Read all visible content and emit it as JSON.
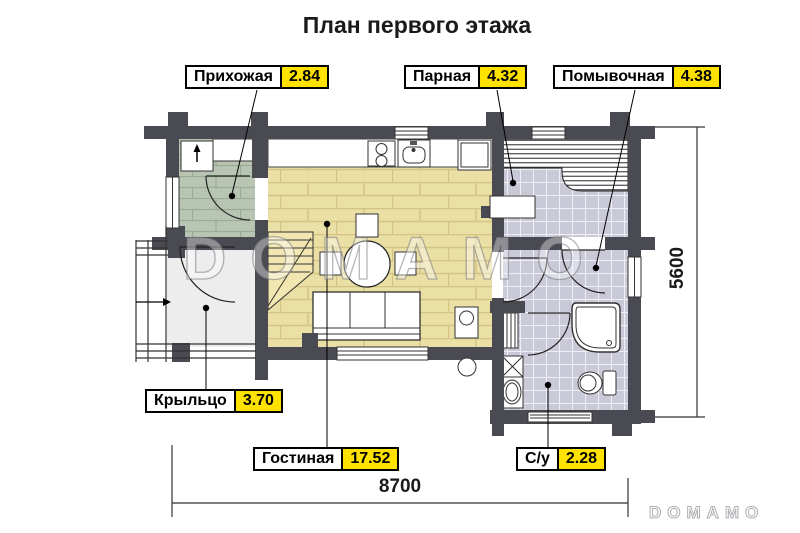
{
  "title": "План первого этажа",
  "floor_plan": {
    "rooms": [
      {
        "id": "hallway",
        "name": "Прихожая",
        "area": "2.84"
      },
      {
        "id": "steam-room",
        "name": "Парная",
        "area": "4.32"
      },
      {
        "id": "washing-room",
        "name": "Помывочная",
        "area": "4.38"
      },
      {
        "id": "porch",
        "name": "Крыльцо",
        "area": "3.70"
      },
      {
        "id": "living-room",
        "name": "Гостиная",
        "area": "17.52"
      },
      {
        "id": "bathroom",
        "name": "С/у",
        "area": "2.28"
      }
    ],
    "dimensions": {
      "width_mm": "8700",
      "height_mm": "5600"
    }
  },
  "watermark": {
    "large": "DOMAMO",
    "small": "DOMAMO"
  },
  "colors": {
    "wall": "#4a4a52",
    "living_floor": "#eadfa5",
    "living_line": "#d5c384",
    "hall_floor": "#b8c5b2",
    "hall_line": "#9cab96",
    "tile_floor": "#c9c9d8",
    "tile_line": "#eff0f6",
    "porch_floor": "#ededed",
    "label_yellow": "#ffe200"
  }
}
